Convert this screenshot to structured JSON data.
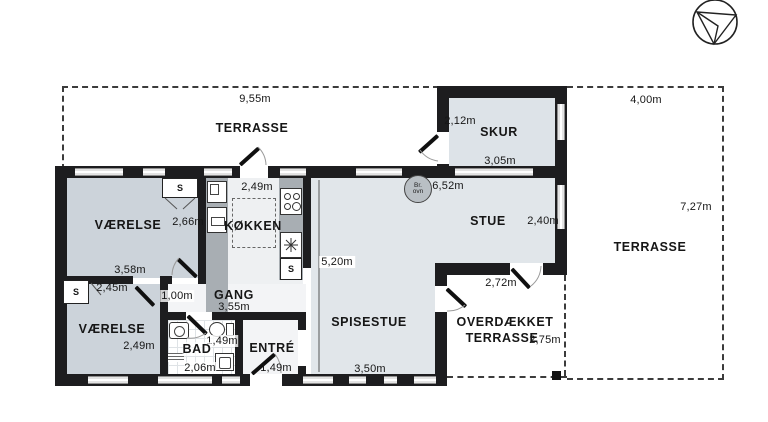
{
  "areas": {
    "terrasseTop": {
      "label": "TERRASSE",
      "dim": "9,55m"
    },
    "terrasseRight": {
      "label": "TERRASSE",
      "dimW": "4,00m",
      "dimH": "7,27m"
    },
    "skur": {
      "label": "SKUR",
      "dimW": "3,05m",
      "dimH": "2,12m"
    },
    "stue": {
      "label": "STUE",
      "dimW": "6,52m",
      "dimH": "2,40m"
    },
    "spisestue": {
      "label": "SPISESTUE",
      "dimW": "3,50m",
      "dimDepth": "5,20m"
    },
    "koekken": {
      "label": "KØKKEN",
      "dimW": "2,49m"
    },
    "gang": {
      "label": "GANG",
      "dimW": "3,55m",
      "dimSide": "1,00m"
    },
    "vaerelse1": {
      "label": "VÆRELSE",
      "dimW": "3,58m",
      "dimH": "2,66m"
    },
    "vaerelse2": {
      "label": "VÆRELSE",
      "dimW": "2,45m",
      "dimH": "2,49m"
    },
    "bad": {
      "label": "BAD",
      "dimW": "2,06m",
      "dimDoor": "1,49m"
    },
    "entre": {
      "label": "ENTRÉ",
      "dimDoor": "1,49m"
    },
    "overdaekket": {
      "label1": "OVERDÆKKET",
      "label2": "TERRASSE",
      "dimW": "2,72m",
      "dimH": "2,75m"
    }
  },
  "symbols": {
    "closet": "S",
    "stove1": "Br.",
    "stove2": "ovn"
  },
  "colors": {
    "wall": "#1d1d1f",
    "room": "#ccd3da",
    "living": "#e1e6ea",
    "service": "#eef0f2",
    "counter": "#a8aeb3"
  }
}
